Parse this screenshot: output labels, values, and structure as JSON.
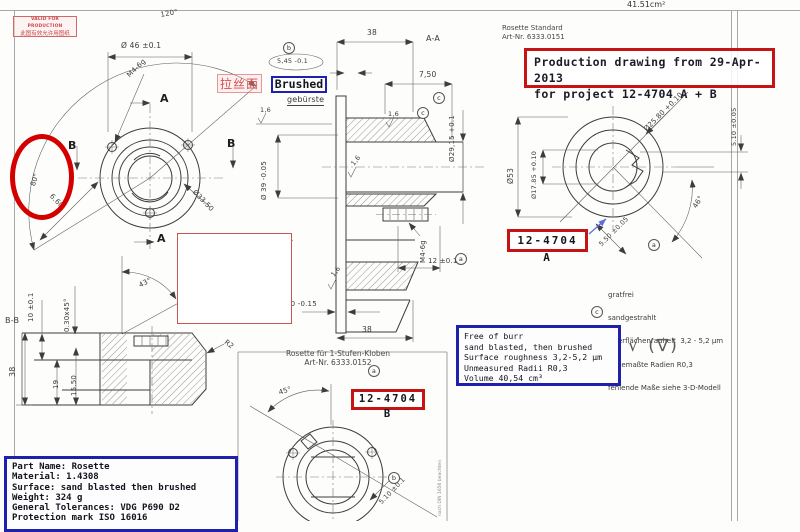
{
  "page": {
    "area_label": "41.51cm²"
  },
  "stamp": {
    "line1": "VALID FOR PRODUCTION",
    "line2": "此图有效允许用图纸"
  },
  "chinese_note": "拉丝面",
  "brushed_label": "Brushed",
  "title_block_a": {
    "line1": "Rosette Standard",
    "line2": "Art-Nr. 6333.0151"
  },
  "production_box": {
    "line1": "Production drawing from 29-Apr-2013",
    "line2": "for project 12-4704 A + B"
  },
  "part_a_tag": "12-4704 A",
  "part_b_tag": "12-4704 B",
  "title_block_b": {
    "line1": "Rosette für 1-Stufen-Kloben",
    "line2": "Art-Nr. 6333.0152"
  },
  "german_notes": {
    "lines": [
      "gratfrei",
      "sandgestrahlt",
      "Oberflächenrauheit  3,2 - 5,2 µm",
      "unbemaßte Radien R0,3",
      "fehlende Maße siehe 3-D-Modell"
    ]
  },
  "english_notes": {
    "lines": [
      "Free of burr",
      "sand blasted, then brushed",
      "Surface roughness 3,2-5,2 µm",
      "Unmeasured Radii R0,3",
      "Volume 40,54 cm³"
    ]
  },
  "part_info": {
    "lines": [
      "Part Name: Rosette",
      "Material: 1.4308",
      "Surface: sand blasted then brushed",
      "Weight: 324 g",
      "General Tolerances: VDG P690 D2",
      "Protection mark ISO 16016"
    ]
  },
  "surface_symbols": "√ (∇)",
  "edge_note": "nach DIN 1656 beachten",
  "colors": {
    "annotation_red": "#c41414",
    "annotation_blue": "#2020ae",
    "highlight_red": "#d40000",
    "line_dark": "#3d3d3d"
  },
  "labels": [
    {
      "t": "120°",
      "x": 160,
      "y": 12,
      "r": -10
    },
    {
      "t": "Ø 46 ±0.1",
      "x": 121,
      "y": 42,
      "s": 7.5
    },
    {
      "t": "M4-6g",
      "x": 126,
      "y": 74,
      "r": -44
    },
    {
      "t": "A",
      "x": 160,
      "y": 93,
      "cls": "sec"
    },
    {
      "t": "A",
      "x": 157,
      "y": 233,
      "cls": "sec"
    },
    {
      "t": "B",
      "x": 68,
      "y": 140,
      "cls": "sec"
    },
    {
      "t": "B",
      "x": 227,
      "y": 138,
      "cls": "sec"
    },
    {
      "t": "80°",
      "x": 30,
      "y": 185,
      "r": -72
    },
    {
      "t": "6.60",
      "x": 53,
      "y": 193,
      "r": 46
    },
    {
      "t": "Ø33.50",
      "x": 196,
      "y": 189,
      "r": 46
    },
    {
      "t": "43°",
      "x": 138,
      "y": 283,
      "r": -27
    },
    {
      "t": "B-B",
      "x": 5,
      "y": 317,
      "s": 8
    },
    {
      "t": "10 ±0.1",
      "x": 28,
      "y": 322,
      "r": -90
    },
    {
      "t": "0.30x45°",
      "x": 64,
      "y": 332,
      "r": -90
    },
    {
      "t": "38",
      "x": 9,
      "y": 377,
      "r": -90,
      "s": 8
    },
    {
      "t": "19",
      "x": 53,
      "y": 389,
      "r": -90
    },
    {
      "t": "15.50",
      "x": 71,
      "y": 396,
      "r": -90
    },
    {
      "t": "R2",
      "x": 227,
      "y": 339,
      "r": 38
    },
    {
      "t": "38",
      "x": 367,
      "y": 29,
      "s": 7.5
    },
    {
      "t": "A-A",
      "x": 426,
      "y": 35,
      "s": 8
    },
    {
      "t": "5,45 -0.1",
      "x": 277,
      "y": 58,
      "s": 6.5
    },
    {
      "t": "gebürste",
      "x": 287,
      "y": 96,
      "s": 8,
      "cls": "und"
    },
    {
      "t": "1,6",
      "x": 260,
      "y": 107,
      "s": 6.5
    },
    {
      "t": "7,50",
      "x": 419,
      "y": 71,
      "s": 7.5
    },
    {
      "t": "1,6",
      "x": 388,
      "y": 111,
      "s": 6.5
    },
    {
      "t": "Ø29,15 +0.1",
      "x": 449,
      "y": 162,
      "r": -90,
      "s": 7
    },
    {
      "t": "Ø 39 -0.05",
      "x": 261,
      "y": 200,
      "r": -90,
      "s": 7
    },
    {
      "t": "1,6",
      "x": 350,
      "y": 163,
      "r": -52,
      "s": 6.5
    },
    {
      "t": "1,6",
      "x": 330,
      "y": 274,
      "r": -52,
      "s": 6.5
    },
    {
      "t": "M4-6g",
      "x": 420,
      "y": 263,
      "r": -90,
      "s": 7
    },
    {
      "t": "12 ±0.1",
      "x": 428,
      "y": 258,
      "s": 7
    },
    {
      "t": "10 -0.15",
      "x": 286,
      "y": 301,
      "s": 7
    },
    {
      "t": "38",
      "x": 362,
      "y": 326,
      "s": 7.5
    },
    {
      "t": "Ø25.80 +0.10",
      "x": 643,
      "y": 128,
      "r": -45,
      "s": 7
    },
    {
      "t": "5.10 ±0.05",
      "x": 731,
      "y": 146,
      "r": -90,
      "s": 6.5
    },
    {
      "t": "Ø53",
      "x": 507,
      "y": 184,
      "r": -90,
      "s": 7.5
    },
    {
      "t": "Ø17.85 +0.10",
      "x": 531,
      "y": 199,
      "r": -90,
      "s": 6.5
    },
    {
      "t": "46°",
      "x": 692,
      "y": 206,
      "r": -58
    },
    {
      "t": "5.50 ±0.05",
      "x": 598,
      "y": 243,
      "r": -45,
      "s": 6.5
    },
    {
      "t": "45°",
      "x": 278,
      "y": 390,
      "r": -18
    },
    {
      "t": "5.10 ±0.1",
      "x": 378,
      "y": 501,
      "r": -46,
      "s": 6.5
    },
    {
      "t": "b",
      "x": 283,
      "y": 42,
      "cls": "circ"
    },
    {
      "t": "c",
      "x": 433,
      "y": 92,
      "cls": "circ"
    },
    {
      "t": "c",
      "x": 417,
      "y": 107,
      "cls": "circ"
    },
    {
      "t": "a",
      "x": 455,
      "y": 253,
      "cls": "circ"
    },
    {
      "t": "a",
      "x": 648,
      "y": 239,
      "cls": "circ"
    },
    {
      "t": "c",
      "x": 591,
      "y": 306,
      "cls": "circ"
    },
    {
      "t": "a",
      "x": 368,
      "y": 365,
      "cls": "circ"
    },
    {
      "t": "b",
      "x": 388,
      "y": 472,
      "cls": "circ"
    }
  ]
}
